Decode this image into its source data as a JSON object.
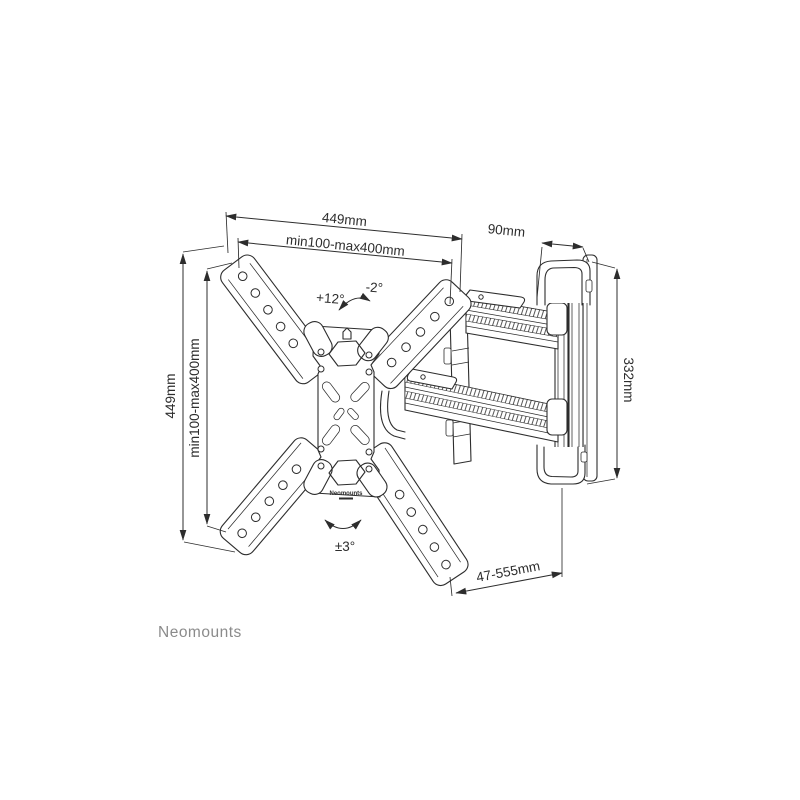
{
  "page": {
    "background": "#ffffff"
  },
  "brand": {
    "name": "Neomounts",
    "color": "#8b8b8b"
  },
  "drawing": {
    "line_color": "#2d2d2d",
    "labels": {
      "width_total": "449mm",
      "width_vesa": "min100-max400mm",
      "height_total": "449mm",
      "height_vesa": "min100-max400mm",
      "bracket_depth": "90mm",
      "bracket_height": "332mm",
      "extension_range": "47-555mm",
      "tilt_up": "+12°",
      "tilt_down": "-2°",
      "rotation_level": "±3°",
      "plate_logo": "Neomounts"
    }
  }
}
